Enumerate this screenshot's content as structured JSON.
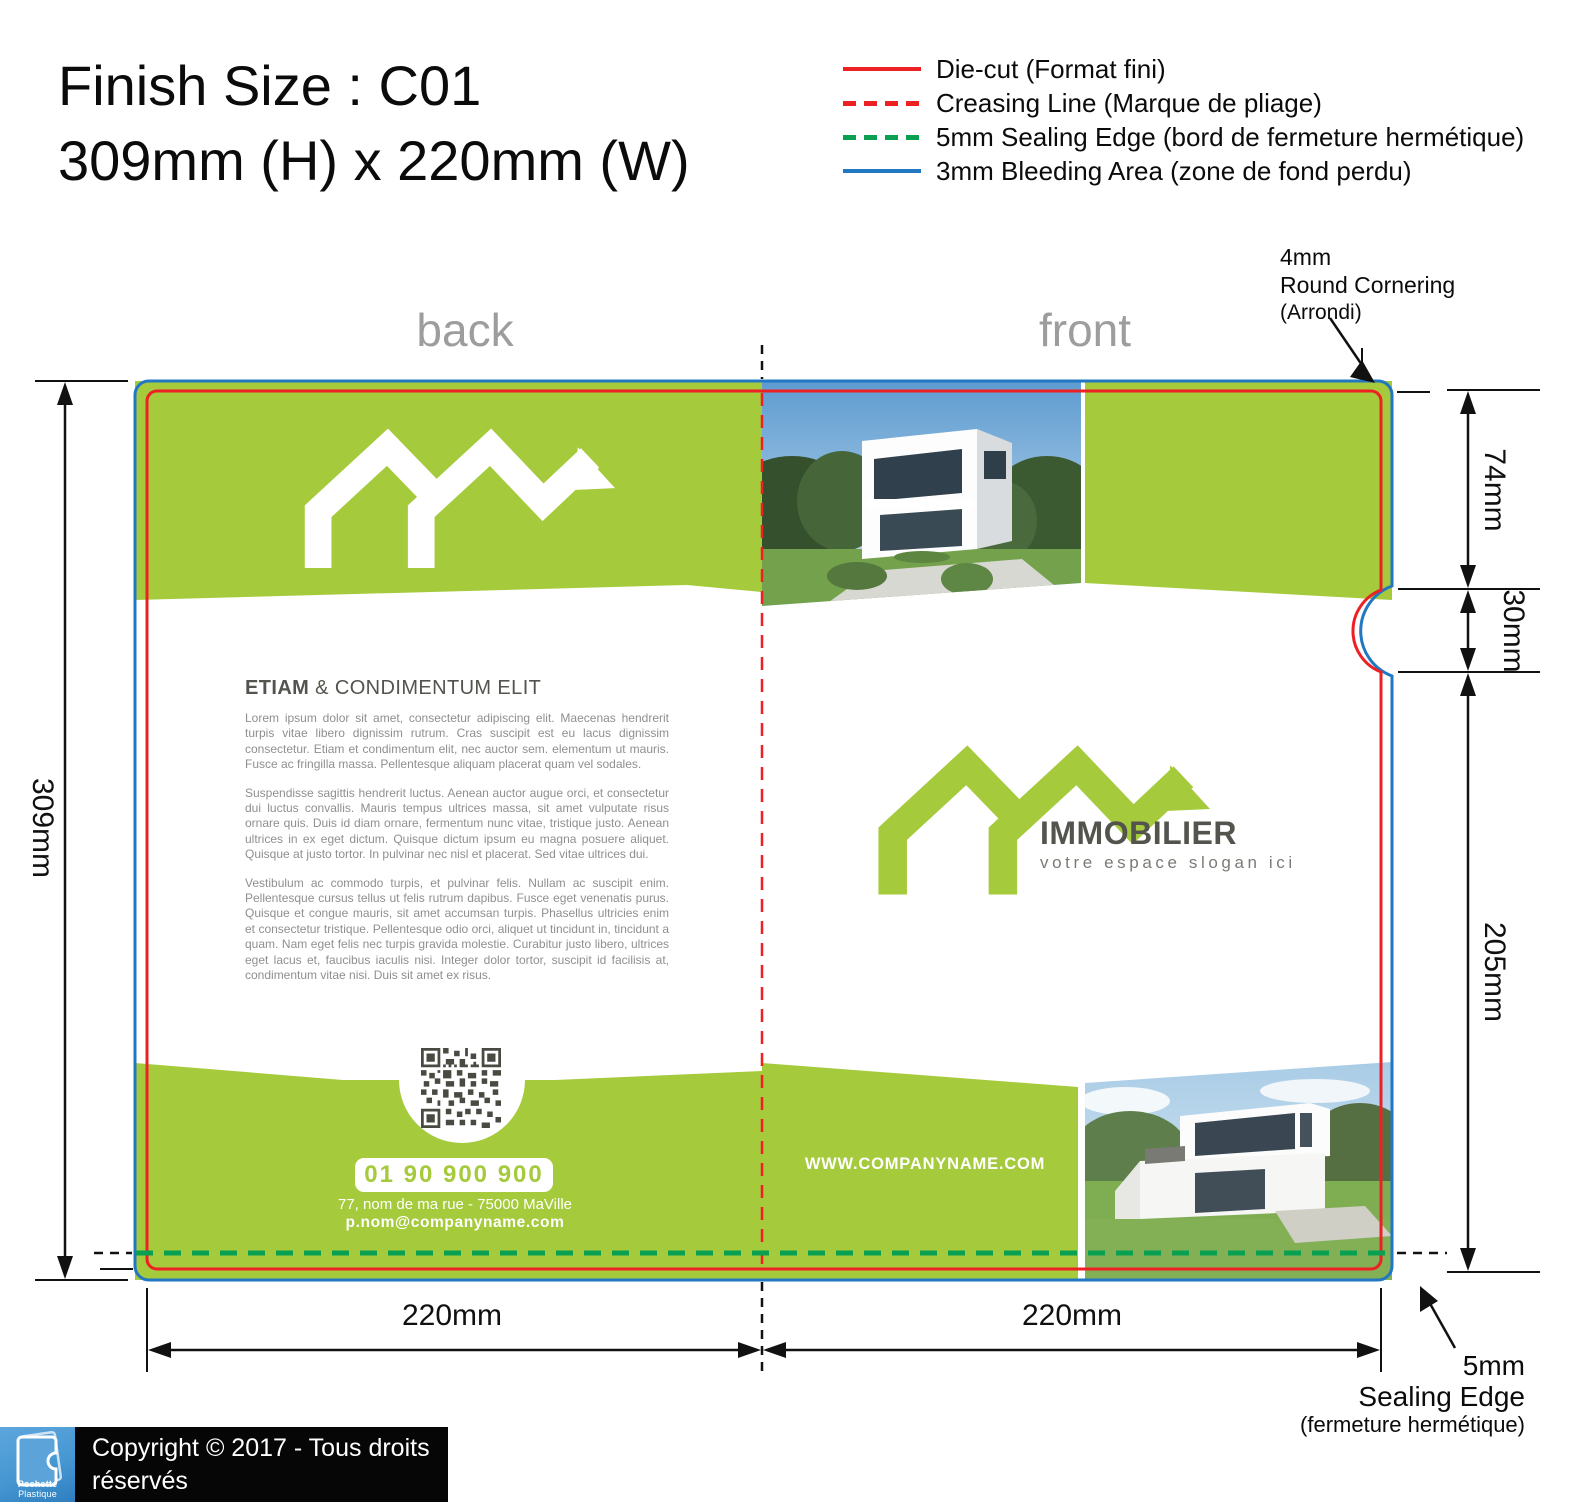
{
  "title": {
    "line1": "Finish Size : C01",
    "line2": "309mm (H) x 220mm (W)"
  },
  "legend": {
    "items": [
      {
        "name": "die-cut",
        "label": "Die-cut (Format fini)",
        "color": "#ed2024",
        "style": "solid"
      },
      {
        "name": "creasing-line",
        "label": "Creasing Line (Marque de pliage)",
        "color": "#ed2024",
        "style": "dashed"
      },
      {
        "name": "sealing-edge",
        "label": "5mm Sealing Edge (bord de fermeture hermétique)",
        "color": "#09a052",
        "style": "dashed"
      },
      {
        "name": "bleeding-area",
        "label": "3mm Bleeding Area (zone de fond perdu)",
        "color": "#2277c3",
        "style": "solid"
      }
    ]
  },
  "panel_labels": {
    "back": "back",
    "front": "front"
  },
  "annotations": {
    "round_corner": {
      "line1": "4mm",
      "line2": "Round Cornering",
      "line3": "(Arrondi)"
    },
    "sealing_edge": {
      "line1": "5mm",
      "line2": "Sealing Edge",
      "line3": "(fermeture hermétique)"
    }
  },
  "dimensions": {
    "total_height": "309mm",
    "top_section": "74mm",
    "notch_section": "30mm",
    "pocket_section": "205mm",
    "back_width": "220mm",
    "front_width": "220mm"
  },
  "back_panel": {
    "heading_bold": "ETIAM",
    "heading_rest": " & CONDIMENTUM ELIT",
    "paragraphs": [
      "Lorem ipsum dolor sit amet, consectetur adipiscing elit. Maecenas hendrerit turpis vitae libero dignissim rutrum. Cras suscipit est eu lacus dignissim consectetur. Etiam et condimentum elit, nec auctor sem. elementum ut mauris. Fusce ac fringilla massa. Pellentesque aliquam placerat quam vel sodales.",
      "Suspendisse sagittis hendrerit luctus. Aenean auctor augue orci, et consectetur dui luctus convallis. Mauris tempus ultrices massa, sit amet vulputate risus ornare quis. Duis id diam ornare, fermentum nunc vitae, tristique justo. Aenean ultrices in ex eget dictum. Quisque dictum ipsum eu magna posuere aliquet. Quisque at justo tortor. In pulvinar nec nisl et placerat. Sed vitae ultrices dui.",
      "Vestibulum ac commodo turpis, et pulvinar felis. Nullam ac suscipit enim. Pellentesque cursus tellus ut felis rutrum dapibus. Fusce eget venenatis purus. Quisque et congue mauris, sit amet accumsan turpis. Phasellus ultricies enim et consectetur tristique. Pellentesque odio orci, aliquet ut tincidunt in, tincidunt a quam. Nam eget felis nec turpis gravida molestie. Curabitur justo libero, ultrices eget lacus et, faucibus iaculis nisi. Integer dolor tortor, suscipit id facilisis at, condimentum vitae nisi. Duis sit amet ex risus."
    ],
    "phone": "01 90 900 900",
    "address": "77, nom de ma rue - 75000 MaVille",
    "email": "p.nom@companyname.com"
  },
  "front_panel": {
    "brand": "IMMOBILIER",
    "slogan": "votre espace slogan ici",
    "website": "WWW.COMPANYNAME.COM"
  },
  "footer": {
    "logo_bold": "Pochette",
    "logo_rest": " Plastique",
    "line1": "Copyright © 2017 - Tous droits réservés",
    "line2": "Pochette Plastique Personnalisée Couleur"
  },
  "colors": {
    "lime": "#a5ca3b",
    "red": "#ed2024",
    "blue": "#2277c3",
    "seal_green": "#09a052",
    "label_grey": "#9d9d9d",
    "dark_text": "#54544e",
    "body_grey": "#8f8f8f",
    "qr_dark": "#4a4a42",
    "footer_blue": "#4697d2"
  }
}
